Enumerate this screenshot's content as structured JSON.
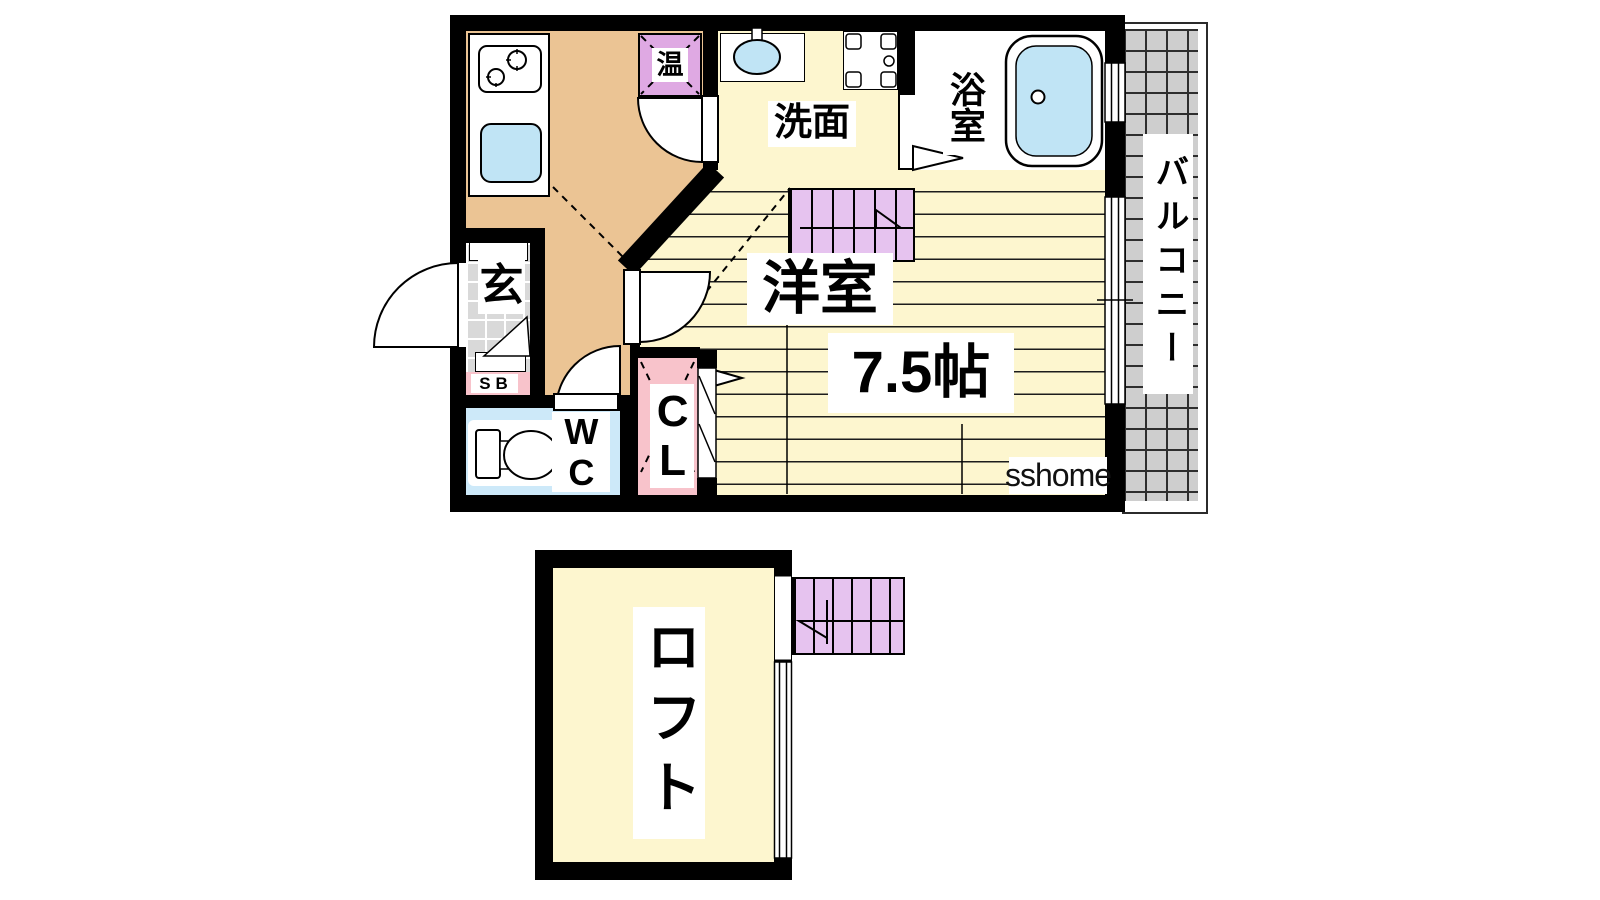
{
  "page": {
    "type": "japanese-apartment-floor-plan",
    "background": "#ffffff"
  },
  "labels": {
    "water_heater": "温",
    "washroom": "洗面",
    "bathroom": "浴室",
    "western_room": "洋室",
    "western_room_size": "7.5帖",
    "entrance": "玄",
    "shoe_box": "SB",
    "wc": "WC",
    "closet": "CL",
    "balcony": "バルコニー",
    "loft": "ロフト",
    "watermark": "sshome"
  },
  "rooms": [
    {
      "id": "kitchen",
      "floor": "tan",
      "fixtures": [
        "gas-stove",
        "kitchen-sink"
      ]
    },
    {
      "id": "water-heater",
      "label": "温"
    },
    {
      "id": "washroom",
      "label": "洗面",
      "fixtures": [
        "washbasin",
        "washing-machine-pan"
      ]
    },
    {
      "id": "bathroom",
      "label": "浴室",
      "fixtures": [
        "bathtub"
      ]
    },
    {
      "id": "western-room",
      "label": "洋室",
      "size": "7.5帖",
      "fixtures": [
        "staircase-up"
      ]
    },
    {
      "id": "entrance",
      "label": "玄",
      "fixtures": [
        "entrance-door",
        "step-triangle"
      ]
    },
    {
      "id": "shoe-box",
      "label": "SB"
    },
    {
      "id": "wc",
      "label": "WC",
      "fixtures": [
        "toilet"
      ]
    },
    {
      "id": "closet",
      "label": "CL",
      "fixtures": [
        "bifold-door"
      ]
    },
    {
      "id": "balcony",
      "label": "バルコニー",
      "floor": "tile-grid"
    },
    {
      "id": "loft",
      "label": "ロフト",
      "fixtures": [
        "staircase-down"
      ]
    }
  ],
  "colors": {
    "wall": "#000000",
    "kitchen_floor": "#ebc494",
    "room_floor": "#fdf6cf",
    "stairs_fill": "#e6c3ef",
    "water_heater_fill": "#dfa9e3",
    "pink_fill": "#f8c3cb",
    "wc_floor": "#cde9f9",
    "fixture_blue": "#c0e4f5",
    "balcony_tile": "#cecece",
    "entrance_tile": "#d9d9d9"
  }
}
